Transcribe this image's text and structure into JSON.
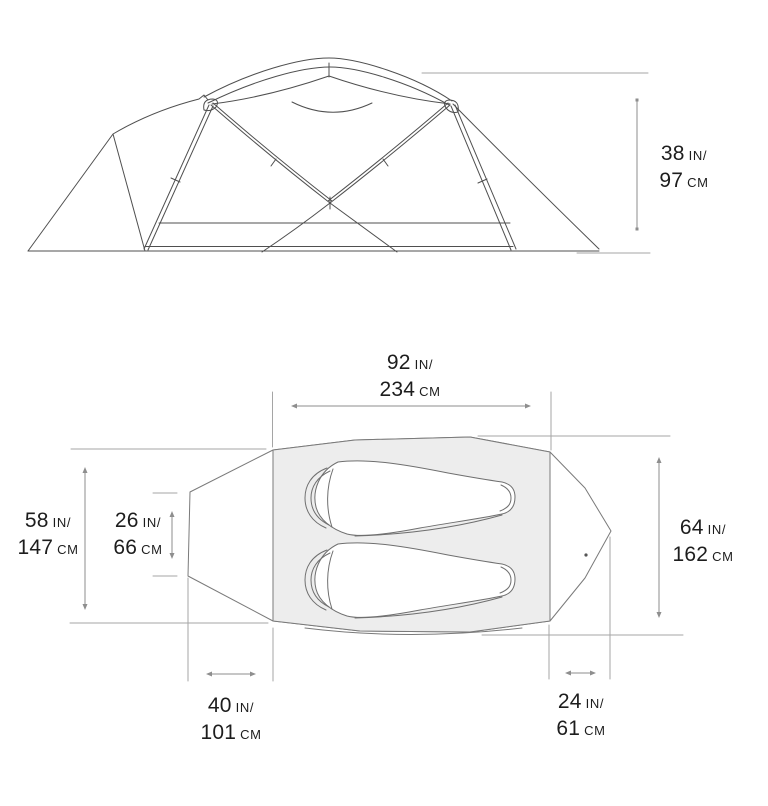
{
  "diagram": {
    "name": "tent-dimensions-spec-diagram",
    "views": {
      "top_view": "side-elevation",
      "bottom_view": "floor-plan"
    }
  },
  "dims": {
    "height": {
      "in": "38",
      "in_unit": "IN/",
      "cm": "97",
      "cm_unit": "CM"
    },
    "floor_length": {
      "in": "92",
      "in_unit": "IN/",
      "cm": "234",
      "cm_unit": "CM"
    },
    "width_head_end": {
      "in": "58",
      "in_unit": "IN/",
      "cm": "147",
      "cm_unit": "CM"
    },
    "left_vestibule_width": {
      "in": "26",
      "in_unit": "IN/",
      "cm": "66",
      "cm_unit": "CM"
    },
    "width_foot_end": {
      "in": "64",
      "in_unit": "IN/",
      "cm": "162",
      "cm_unit": "CM"
    },
    "left_vestibule_depth": {
      "in": "40",
      "in_unit": "IN/",
      "cm": "101",
      "cm_unit": "CM"
    },
    "right_vestibule_depth": {
      "in": "24",
      "in_unit": "IN/",
      "cm": "61",
      "cm_unit": "CM"
    }
  },
  "colors": {
    "background": "#ffffff",
    "tent_line": "#4f4f4f",
    "plan_line": "#7a7a7a",
    "bag_line": "#6f6f6f",
    "floor_fill": "#ededed",
    "dimension_line": "#8e8e8e",
    "extension_line": "#a5a5a5",
    "text": "#1d1d1d"
  }
}
